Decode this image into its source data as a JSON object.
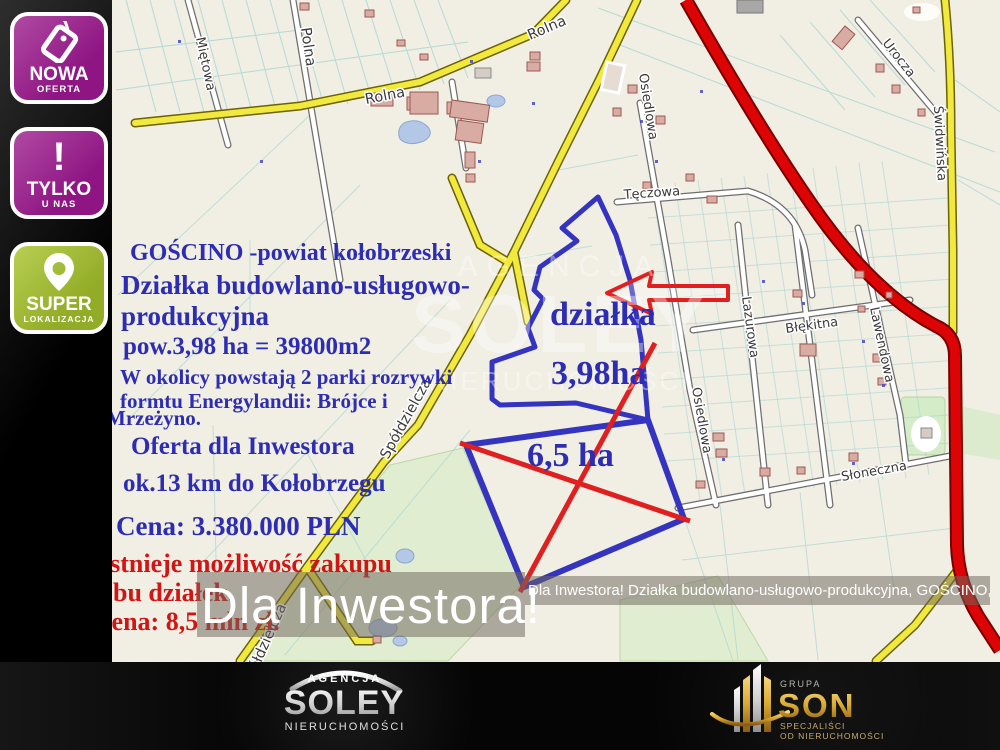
{
  "badges": [
    {
      "top": "NOWA",
      "bottom": "OFERTA",
      "icon": "tag-icon",
      "color": "#9e2493"
    },
    {
      "top": "TYLKO",
      "bottom": "U NAS",
      "icon": "exclamation-icon",
      "color": "#9e2493"
    },
    {
      "top": "SUPER",
      "bottom": "LOKALIZACJA",
      "icon": "location-pin-icon",
      "color": "#a3bf3a"
    }
  ],
  "overlay": {
    "lines": [
      {
        "text": "GOŚCINO -powiat kołobrzeski"
      },
      {
        "text": "Działka budowlano-usługowo-"
      },
      {
        "text": "produkcyjna"
      },
      {
        "text": "pow.3,98 ha = 39800m2"
      },
      {
        "text": "W okolicy powstają 2 parki rozrywki"
      },
      {
        "text": "formtu Energylandii: Brójce i"
      },
      {
        "text": "Mrzeżyno."
      },
      {
        "text": "Oferta dla Inwestora"
      },
      {
        "text": "ok.13 km do Kołobrzegu"
      },
      {
        "text": "Cena: 3.380.000 PLN"
      },
      {
        "text": "Istnieje możliwość zakupu"
      },
      {
        "text": "obu działek."
      },
      {
        "text": "cena: 8,5 mln zł."
      }
    ]
  },
  "map": {
    "streets": {
      "mietowa": "Miętowa",
      "polna": "Polna",
      "rolna": "Rolna",
      "spoldzielcza": "Spółdzielcza",
      "osiedlowa": "Osiedlowa",
      "teczowa": "Tęczowa",
      "lazurowa": "Lazurowa",
      "blekitna": "Błękitna",
      "lawendowa": "Lawendowa",
      "urocza": "Urocza",
      "swidwinska": "Świdwińska",
      "sloneczna": "Słoneczna"
    },
    "annotations": {
      "dzialka": "działka",
      "area_398": "3,98ha",
      "area_65": "6,5 ha"
    }
  },
  "banner": {
    "big": "Dla Inwestora!",
    "small": "Dla Inwestora! Działka budowlano-usługowo-produkcyjna, GOŚCINO, powiat kołobrzeski"
  },
  "watermark": {
    "l1": "AGENCJA",
    "l2": "SOLEY",
    "l3": "NIERUCHOMOŚCI"
  },
  "footer": {
    "soley": {
      "agency": "AGENCJA",
      "name": "SOLEY",
      "sub": "NIERUCHOMOŚCI"
    },
    "son": {
      "group": "GRUPA",
      "name": "SON",
      "sub1": "SPECJALIŚCI",
      "sub2": "OD NIERUCHOMOŚCI"
    }
  },
  "colors": {
    "badge_magenta": "#9e2493",
    "badge_green": "#a3bf3a",
    "annotation_blue": "#2d2db4",
    "annotation_red": "#d11414",
    "parcel_outline_blue": "#3434c0",
    "cross_red": "#e02020",
    "road_yellow": "#f2e93e",
    "road_red": "#dc0404"
  }
}
